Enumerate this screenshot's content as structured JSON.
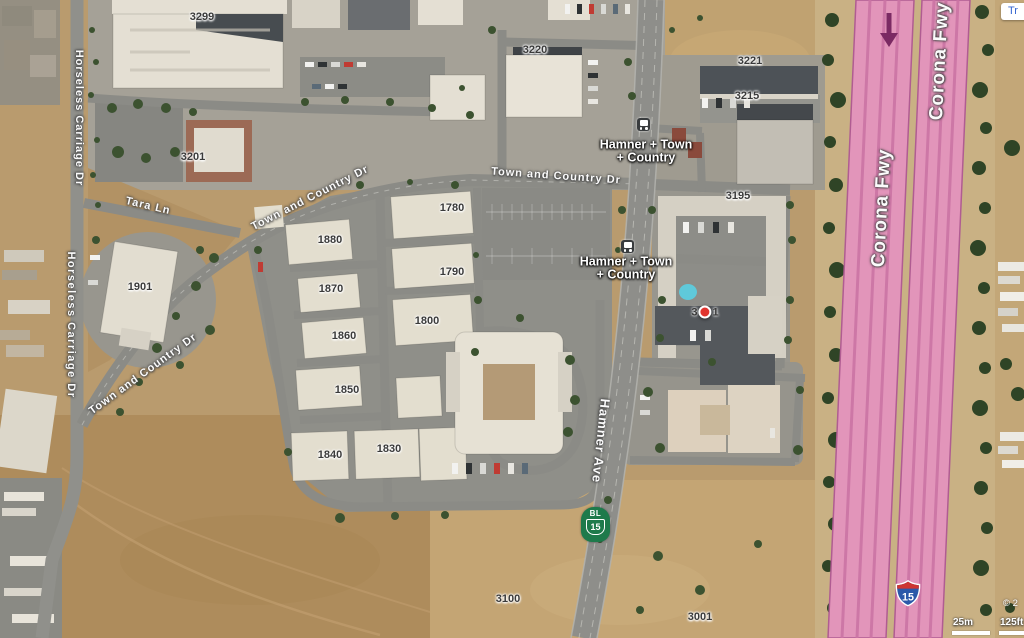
{
  "map": {
    "streets": {
      "horseless_1": "Horseless Carriage Dr",
      "horseless_2": "Horseless Carriage Dr",
      "tara": "Tara Ln",
      "town_country_1": "Town and Country Dr",
      "town_country_2": "Town and Country Dr",
      "town_country_3": "Town and Country Dr",
      "hamner": "Hamner Ave",
      "corona_1": "Corona Fwy",
      "corona_2": "Corona Fwy"
    },
    "buildings": {
      "b3299": "3299",
      "b3220": "3220",
      "b3221": "3221",
      "b3215": "3215",
      "b3201": "3201",
      "b3195": "3195",
      "b1780": "1780",
      "b1880": "1880",
      "b1790": "1790",
      "b1870": "1870",
      "b1800": "1800",
      "b1860": "1860",
      "b1850": "1850",
      "b1840": "1840",
      "b1830": "1830",
      "b1901": "1901",
      "b3100": "3100",
      "b3001": "3001"
    },
    "transit": {
      "stop1_line1": "Hamner + Town",
      "stop1_line2": "+ Country",
      "stop2_line1": "Hamner + Town",
      "stop2_line2": "+ Country"
    },
    "marker": {
      "prefix": "3",
      "suffix": "1"
    },
    "shields": {
      "bl_label": "BL",
      "bl_number": "15",
      "i15_number": "15"
    },
    "controls": {
      "traffic_label": "Tr"
    },
    "scale": {
      "metric": "25m",
      "imperial": "125ft",
      "copyright": "© 2"
    },
    "colors": {
      "freeway_highlight": "#e295ba",
      "freeway_stripe": "#cb74a4",
      "direction_arrow": "#7b2a63",
      "marker_red": "#e0342e",
      "business_loop_green": "#1e7a4b",
      "interstate_blue": "#2b59a9",
      "interstate_red": "#cd3632",
      "traffic_link_blue": "#3465d0"
    }
  }
}
